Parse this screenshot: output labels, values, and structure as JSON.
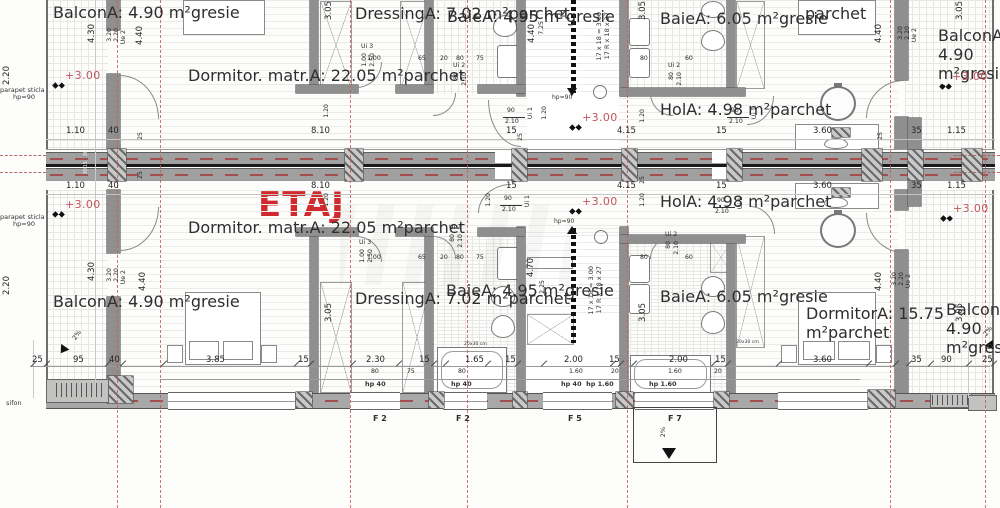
{
  "title": "ETAJ",
  "accent_red": "#d02a2e",
  "level_text": "+3.00",
  "levels": [
    {
      "x": 65,
      "y": 70
    },
    {
      "x": 582,
      "y": 112
    },
    {
      "x": 952,
      "y": 71
    },
    {
      "x": 65,
      "y": 199
    },
    {
      "x": 582,
      "y": 196
    },
    {
      "x": 953,
      "y": 203
    }
  ],
  "rooms": [
    {
      "n": "Balcon",
      "a": "A: 4.90 m²",
      "f": "gresie",
      "x": 53,
      "y": 3
    },
    {
      "n": "Dormitor. matr.",
      "a": "A: 22.05 m²",
      "f": "parchet",
      "x": 188,
      "y": 66
    },
    {
      "n": "Dressing",
      "a": "A: 7.02 m²",
      "f": "parchet",
      "x": 355,
      "y": 4
    },
    {
      "n": "Baie",
      "a": "A: 4.95 m²",
      "f": "gresie",
      "x": 447,
      "y": 7
    },
    {
      "n": "Baie",
      "a": "A: 6.05 m²",
      "f": "gresie",
      "x": 660,
      "y": 9
    },
    {
      "n": "Hol",
      "a": "A: 4.98 m²",
      "f": "parchet",
      "x": 660,
      "y": 100
    },
    {
      "f": "parchet",
      "x": 805,
      "y": 4
    },
    {
      "n": "Balcon",
      "a": "A: 4.90 m²",
      "f": "gresie",
      "x": 938,
      "y": 26
    },
    {
      "n": "Balcon",
      "a": "A: 4.90 m²",
      "f": "gresie",
      "x": 53,
      "y": 292
    },
    {
      "n": "Dormitor. matr.",
      "a": "A: 22.05 m²",
      "f": "parchet",
      "x": 188,
      "y": 218
    },
    {
      "n": "Dressing",
      "a": "A: 7.02 m²",
      "f": "parchet",
      "x": 355,
      "y": 289
    },
    {
      "n": "Baie",
      "a": "A: 4.95 m²",
      "f": "gresie",
      "x": 446,
      "y": 281
    },
    {
      "n": "Hol",
      "a": "A: 4.98 m²",
      "f": "parchet",
      "x": 660,
      "y": 192
    },
    {
      "n": "Baie",
      "a": "A: 6.05 m²",
      "f": "gresie",
      "x": 660,
      "y": 287
    },
    {
      "n": "Dormitor",
      "a": "A: 15.75 m²",
      "f": "parchet",
      "x": 806,
      "y": 304
    },
    {
      "n": "Balcon",
      "a": "A: 4.90 m²",
      "f": "gresie",
      "x": 946,
      "y": 300
    }
  ],
  "doors": [
    {
      "code": "Ui 1",
      "wd": "90",
      "ht": "2.10",
      "x": 503,
      "y": 108,
      "st": "h"
    },
    {
      "code": "Ui 1",
      "wd": "90",
      "ht": "2.10",
      "x": 727,
      "y": 108,
      "st": "h"
    },
    {
      "code": "Ui 1",
      "wd": "90",
      "ht": "2.10",
      "x": 500,
      "y": 196,
      "st": "h"
    },
    {
      "code": "Ui 1",
      "wd": "90",
      "ht": "2.10",
      "x": 713,
      "y": 198,
      "st": "h"
    },
    {
      "code": "Ui 2",
      "wd": "80",
      "ht": "2.10",
      "x": 453,
      "y": 63,
      "st": "v"
    },
    {
      "code": "Ui 2",
      "wd": "80",
      "ht": "2.10",
      "x": 668,
      "y": 63,
      "st": "v"
    },
    {
      "code": "Ui 2",
      "wd": "80",
      "ht": "2.10",
      "x": 449,
      "y": 225,
      "st": "v"
    },
    {
      "code": "Ui 2",
      "wd": "80",
      "ht": "2.10",
      "x": 665,
      "y": 232,
      "st": "v"
    },
    {
      "code": "Ui 3",
      "wd": "1.00",
      "ht": "2.50",
      "x": 361,
      "y": 44,
      "st": "v"
    },
    {
      "code": "Ui 3",
      "wd": "1.00",
      "ht": "2.50",
      "x": 359,
      "y": 240,
      "st": "v"
    }
  ],
  "window_labels": [
    {
      "t": "F 2",
      "x": 373,
      "y": 415
    },
    {
      "t": "F 2",
      "x": 456,
      "y": 415
    },
    {
      "t": "F 5",
      "x": 568,
      "y": 415
    },
    {
      "t": "F 7",
      "x": 668,
      "y": 415
    }
  ],
  "notes": [
    {
      "t": "parapet sticla",
      "x": 0,
      "y": 87
    },
    {
      "t": "hp=90",
      "x": 13,
      "y": 94
    },
    {
      "t": "parapet sticla",
      "x": 0,
      "y": 214
    },
    {
      "t": "hp=90",
      "x": 13,
      "y": 221
    },
    {
      "t": "sifon",
      "x": 6,
      "y": 400
    },
    {
      "t": "hp=90",
      "x": 552,
      "y": 95,
      "s": 1
    },
    {
      "t": "hp=90",
      "x": 554,
      "y": 219,
      "s": 1
    },
    {
      "t": "hp 40",
      "x": 365,
      "y": 381,
      "b": 1
    },
    {
      "t": "hp 40",
      "x": 451,
      "y": 381,
      "b": 1
    },
    {
      "t": "hp 40  hp 1.60",
      "x": 561,
      "y": 381,
      "b": 1
    },
    {
      "t": "hp 1.60",
      "x": 649,
      "y": 381,
      "b": 1
    },
    {
      "t": "17 x 18 = 3.00",
      "x": 596,
      "y": 12,
      "v": 1,
      "c": 1
    },
    {
      "t": "17 R x 18 x 27",
      "x": 604,
      "y": 12,
      "v": 1,
      "c": 1
    },
    {
      "t": "17 x 18 = 3.00",
      "x": 588,
      "y": 266,
      "v": 1,
      "c": 1
    },
    {
      "t": "17 R x 18 x 27",
      "x": 596,
      "y": 266,
      "v": 1,
      "c": 1
    },
    {
      "t": "2%",
      "x": 72,
      "y": 332,
      "r": -55
    },
    {
      "t": "2%",
      "x": 983,
      "y": 328,
      "r": -55
    },
    {
      "t": "2%",
      "x": 660,
      "y": 427,
      "v": 1
    },
    {
      "t": "20x30 cm",
      "x": 464,
      "y": 343,
      "xs": 1
    },
    {
      "t": "20x30 cm",
      "x": 736,
      "y": 341,
      "xs": 1
    }
  ],
  "dims": [
    {
      "t": "1.10",
      "x": 66,
      "y": 127
    },
    {
      "t": "40",
      "x": 108,
      "y": 127
    },
    {
      "t": "8.10",
      "x": 311,
      "y": 127
    },
    {
      "t": "15",
      "x": 506,
      "y": 127
    },
    {
      "t": "4.15",
      "x": 617,
      "y": 127
    },
    {
      "t": "15",
      "x": 716,
      "y": 127
    },
    {
      "t": "3.60",
      "x": 813,
      "y": 127
    },
    {
      "t": "35",
      "x": 911,
      "y": 127
    },
    {
      "t": "1.15",
      "x": 947,
      "y": 127
    },
    {
      "t": "1.10",
      "x": 66,
      "y": 182
    },
    {
      "t": "40",
      "x": 108,
      "y": 182
    },
    {
      "t": "8.10",
      "x": 311,
      "y": 182
    },
    {
      "t": "15",
      "x": 506,
      "y": 182
    },
    {
      "t": "4.15",
      "x": 617,
      "y": 182
    },
    {
      "t": "15",
      "x": 716,
      "y": 182
    },
    {
      "t": "3.60",
      "x": 813,
      "y": 182
    },
    {
      "t": "35",
      "x": 911,
      "y": 182
    },
    {
      "t": "1.15",
      "x": 947,
      "y": 182
    },
    {
      "t": "25",
      "x": 32,
      "y": 356
    },
    {
      "t": "95",
      "x": 73,
      "y": 356
    },
    {
      "t": "40",
      "x": 109,
      "y": 356
    },
    {
      "t": "3.85",
      "x": 206,
      "y": 356
    },
    {
      "t": "15",
      "x": 298,
      "y": 356
    },
    {
      "t": "2.30",
      "x": 366,
      "y": 356
    },
    {
      "t": "15",
      "x": 419,
      "y": 356
    },
    {
      "t": "1.65",
      "x": 465,
      "y": 356
    },
    {
      "t": "15",
      "x": 505,
      "y": 356
    },
    {
      "t": "2.00",
      "x": 564,
      "y": 356
    },
    {
      "t": "15",
      "x": 609,
      "y": 356
    },
    {
      "t": "2.00",
      "x": 669,
      "y": 356
    },
    {
      "t": "15",
      "x": 715,
      "y": 356
    },
    {
      "t": "3.60",
      "x": 813,
      "y": 356
    },
    {
      "t": "35",
      "x": 911,
      "y": 356
    },
    {
      "t": "90",
      "x": 941,
      "y": 356
    },
    {
      "t": "25",
      "x": 982,
      "y": 356
    },
    {
      "t": "80",
      "x": 371,
      "y": 369,
      "s": 1
    },
    {
      "t": "75",
      "x": 407,
      "y": 369,
      "s": 1
    },
    {
      "t": "80",
      "x": 458,
      "y": 369,
      "s": 1
    },
    {
      "t": "1.60",
      "x": 569,
      "y": 369,
      "s": 1
    },
    {
      "t": "20",
      "x": 611,
      "y": 369,
      "s": 1
    },
    {
      "t": "1.60",
      "x": 668,
      "y": 369,
      "s": 1
    },
    {
      "t": "20",
      "x": 714,
      "y": 369,
      "s": 1
    },
    {
      "t": "1.00",
      "x": 367,
      "y": 56,
      "s": 1
    },
    {
      "t": "65",
      "x": 418,
      "y": 56,
      "s": 1
    },
    {
      "t": "20",
      "x": 440,
      "y": 56,
      "s": 1
    },
    {
      "t": "80",
      "x": 456,
      "y": 56,
      "s": 1
    },
    {
      "t": "75",
      "x": 476,
      "y": 56,
      "s": 1
    },
    {
      "t": "80",
      "x": 640,
      "y": 56,
      "s": 1
    },
    {
      "t": "60",
      "x": 685,
      "y": 56,
      "s": 1
    },
    {
      "t": "1.00",
      "x": 367,
      "y": 255,
      "s": 1
    },
    {
      "t": "65",
      "x": 418,
      "y": 255,
      "s": 1
    },
    {
      "t": "20",
      "x": 440,
      "y": 255,
      "s": 1
    },
    {
      "t": "80",
      "x": 456,
      "y": 255,
      "s": 1
    },
    {
      "t": "75",
      "x": 476,
      "y": 255,
      "s": 1
    },
    {
      "t": "80",
      "x": 640,
      "y": 255,
      "s": 1
    },
    {
      "t": "60",
      "x": 685,
      "y": 255,
      "s": 1
    },
    {
      "t": "2.20",
      "x": 3,
      "y": 66,
      "v": 1
    },
    {
      "t": "2.20",
      "x": 3,
      "y": 276,
      "v": 1
    },
    {
      "t": "4.30",
      "x": 88,
      "y": 24,
      "v": 1
    },
    {
      "t": "4.30",
      "x": 88,
      "y": 262,
      "v": 1
    },
    {
      "t": "3.20",
      "x": 107,
      "y": 28,
      "v": 1,
      "s": 1
    },
    {
      "t": "2.20",
      "x": 114,
      "y": 28,
      "v": 1,
      "s": 1
    },
    {
      "t": "Ue 2",
      "x": 121,
      "y": 30,
      "v": 1,
      "s": 1
    },
    {
      "t": "3.20",
      "x": 107,
      "y": 268,
      "v": 1,
      "s": 1
    },
    {
      "t": "2.20",
      "x": 114,
      "y": 268,
      "v": 1,
      "s": 1
    },
    {
      "t": "Ue 2",
      "x": 121,
      "y": 270,
      "v": 1,
      "s": 1
    },
    {
      "t": "4.40",
      "x": 136,
      "y": 26,
      "v": 1
    },
    {
      "t": "4.40",
      "x": 139,
      "y": 272,
      "v": 1
    },
    {
      "t": "25",
      "x": 138,
      "y": 132,
      "v": 1,
      "s": 1
    },
    {
      "t": "25",
      "x": 138,
      "y": 171,
      "v": 1,
      "s": 1
    },
    {
      "t": "3.05",
      "x": 325,
      "y": 1,
      "v": 1
    },
    {
      "t": "3.05",
      "x": 325,
      "y": 303,
      "v": 1
    },
    {
      "t": "1.20",
      "x": 324,
      "y": 104,
      "v": 1,
      "s": 1
    },
    {
      "t": "1.20",
      "x": 324,
      "y": 193,
      "v": 1,
      "s": 1
    },
    {
      "t": "3.05",
      "x": 639,
      "y": 1,
      "v": 1
    },
    {
      "t": "3.05",
      "x": 639,
      "y": 303,
      "v": 1
    },
    {
      "t": "1.20",
      "x": 640,
      "y": 109,
      "v": 1,
      "s": 1
    },
    {
      "t": "1.20",
      "x": 640,
      "y": 193,
      "v": 1,
      "s": 1
    },
    {
      "t": "25",
      "x": 640,
      "y": 176,
      "v": 1,
      "s": 1
    },
    {
      "t": "25",
      "x": 518,
      "y": 133,
      "v": 1,
      "s": 1
    },
    {
      "t": "4.40",
      "x": 528,
      "y": 24,
      "v": 1
    },
    {
      "t": "7.25",
      "x": 539,
      "y": 21,
      "v": 1,
      "s": 1
    },
    {
      "t": "4.70",
      "x": 527,
      "y": 258,
      "v": 1
    },
    {
      "t": "2.25",
      "x": 540,
      "y": 280,
      "v": 1,
      "s": 1
    },
    {
      "t": "1.20",
      "x": 542,
      "y": 106,
      "v": 1,
      "s": 1
    },
    {
      "t": "1.20",
      "x": 486,
      "y": 193,
      "v": 1,
      "s": 1
    },
    {
      "t": "4.40",
      "x": 875,
      "y": 24,
      "v": 1
    },
    {
      "t": "4.40",
      "x": 875,
      "y": 272,
      "v": 1
    },
    {
      "t": "25",
      "x": 878,
      "y": 132,
      "v": 1,
      "s": 1
    },
    {
      "t": "3.20",
      "x": 898,
      "y": 26,
      "v": 1,
      "s": 1
    },
    {
      "t": "2.20",
      "x": 905,
      "y": 26,
      "v": 1,
      "s": 1
    },
    {
      "t": "Ue 2",
      "x": 912,
      "y": 28,
      "v": 1,
      "s": 1
    },
    {
      "t": "3.20",
      "x": 892,
      "y": 272,
      "v": 1,
      "s": 1
    },
    {
      "t": "2.20",
      "x": 899,
      "y": 272,
      "v": 1,
      "s": 1
    },
    {
      "t": "Ue 2",
      "x": 906,
      "y": 274,
      "v": 1,
      "s": 1
    },
    {
      "t": "3.05",
      "x": 956,
      "y": 1,
      "v": 1
    },
    {
      "t": "3.05",
      "x": 956,
      "y": 303,
      "v": 1
    },
    {
      "t": "30",
      "x": 84,
      "y": 150,
      "v": 1,
      "xs": 1,
      "w": 1
    },
    {
      "t": "15",
      "x": 84,
      "y": 161,
      "v": 1,
      "xs": 1,
      "w": 1
    },
    {
      "t": "30",
      "x": 84,
      "y": 168,
      "v": 1,
      "xs": 1,
      "w": 1
    }
  ]
}
